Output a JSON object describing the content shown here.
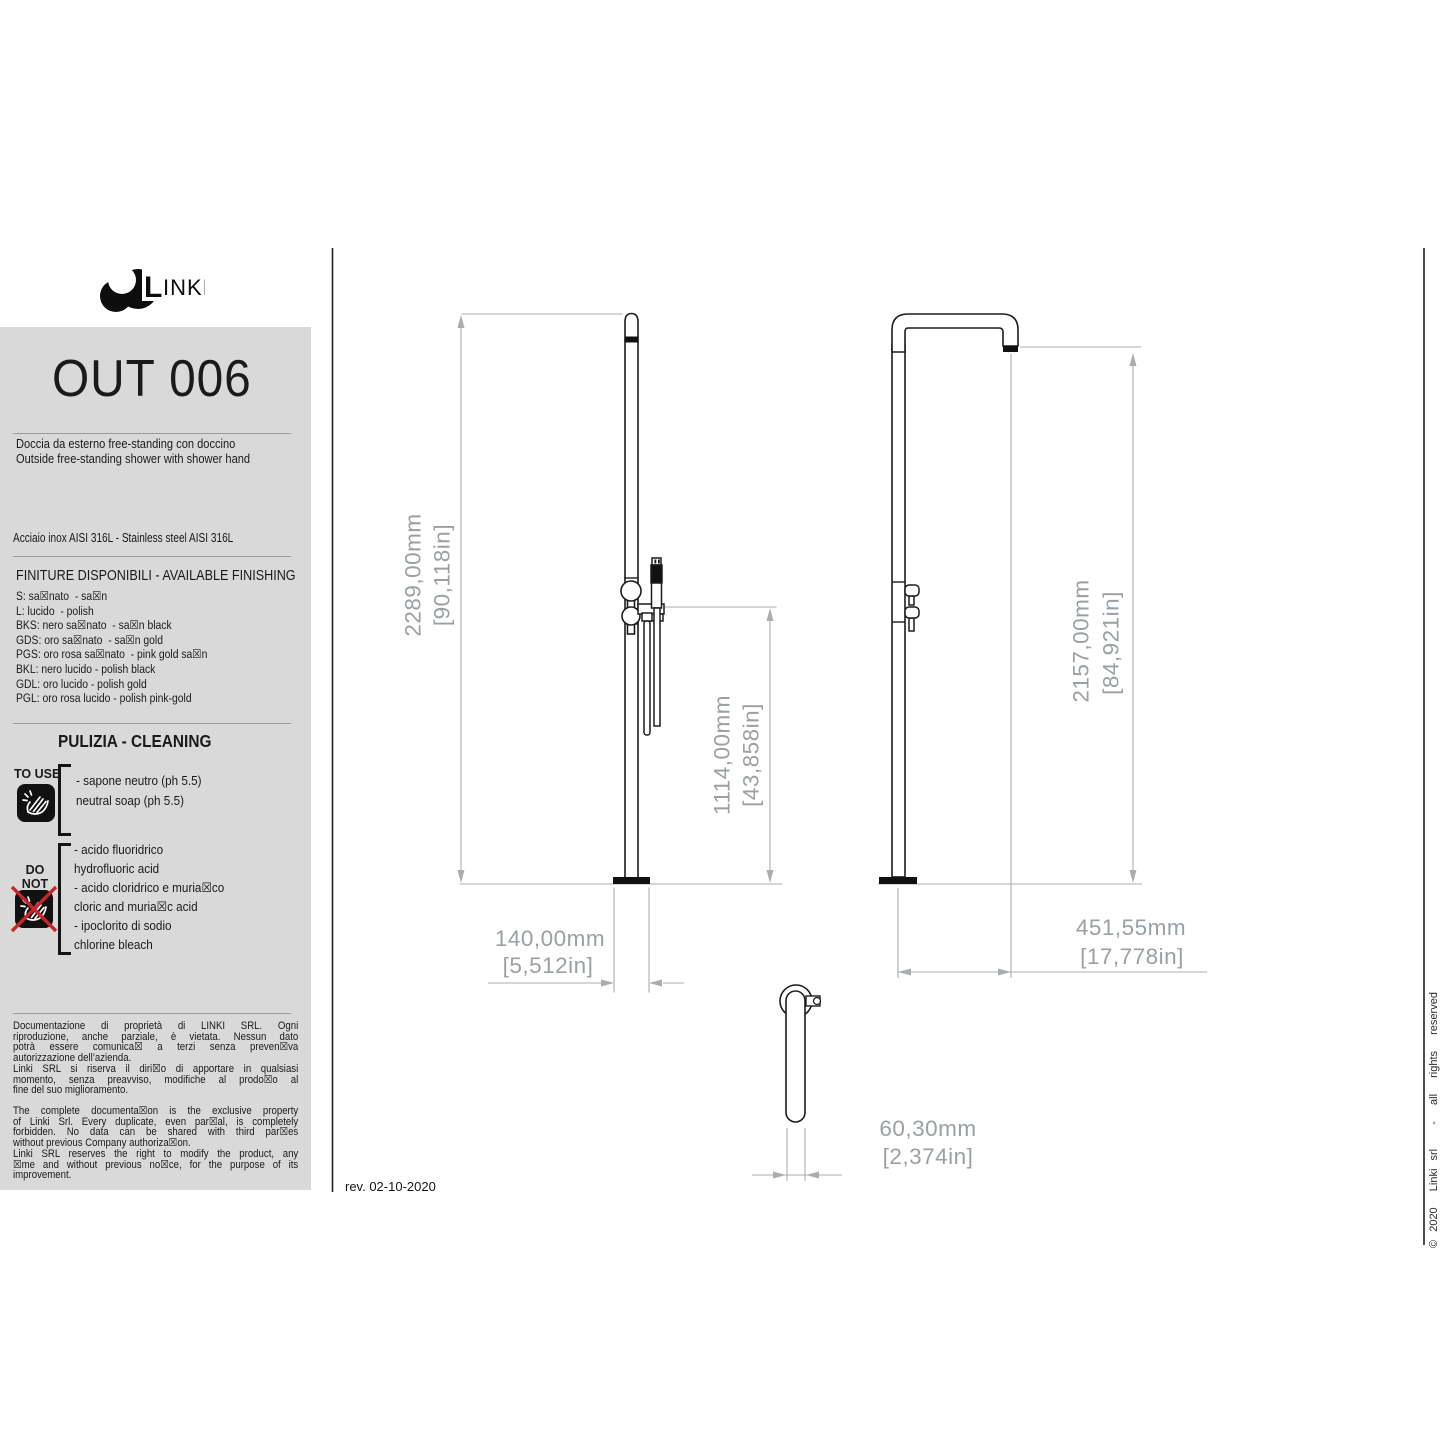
{
  "brand": {
    "name": "LINKI",
    "logo_l": "L",
    "logo_rest": "INKI"
  },
  "header": {
    "code": "OUT 006",
    "description_it": "Doccia da esterno free-standing con doccino",
    "description_en": "Outside free-standing shower with shower hand"
  },
  "specs": {
    "material": "Acciaio inox AISI 316L - Stainless steel AISI 316L",
    "finishing_title": "FINITURE DISPONIBILI - AVAILABLE FINISHING",
    "finishing_options": [
      "S: sa☒nato  - sa☒n",
      "L: lucido  - polish",
      "BKS: nero sa☒nato  - sa☒n black",
      "GDS: oro sa☒nato  - sa☒n gold",
      "PGS: oro rosa sa☒nato  - pink gold sa☒n",
      "BKL: nero lucido - polish black",
      "GDL: oro lucido - polish gold",
      "PGL: oro rosa lucido - polish pink-gold"
    ]
  },
  "cleaning": {
    "title": "PULIZIA - CLEANING",
    "to_use_label": "TO USE",
    "to_use_items": [
      "- sapone neutro (ph 5.5)",
      "neutral soap (ph 5.5)"
    ],
    "do_not_use_label_1": "DO NOT",
    "do_not_use_label_2": "USE",
    "do_not_use_items": [
      "- acido fluoridrico",
      "hydrofluoric acid",
      "- acido cloridrico e muria☒co",
      "cloric and muria☒c acid",
      "- ipoclorito di sodio",
      "chlorine bleach"
    ]
  },
  "legal": {
    "it_lines": [
      "Documentazione di proprietà di LINKI SRL. Ogni",
      "riproduzione, anche parziale, è vietata. Nessun dato",
      "potrà essere comunica☒ a terzi senza preven☒va",
      "autorizzazione dell’azienda.",
      "Linki SRL si riserva il diri☒o di apportare in qualsiasi",
      "momento, senza preavviso, modifiche al prodo☒o al",
      "fine del suo miglioramento."
    ],
    "en_lines": [
      "The complete documenta☒on is the exclusive property",
      "of Linki Srl. Every duplicate, even par☒al, is completely",
      "forbidden. No data can be shared with third par☒es",
      "without previous Company authoriza☒on.",
      "Linki SRL  reserves the right to modify the product, any",
      "☒me and without previous no☒ce, for the purpose of its",
      "improvement."
    ]
  },
  "footer": {
    "revision": "rev. 02-10-2020",
    "copyright": "© 2020  Linki srl   -  all  rights  reserved"
  },
  "dimensions": {
    "front_height": {
      "mm": "2289,00mm",
      "inches": "[90,118in]"
    },
    "mixer_height": {
      "mm": "1114,00mm",
      "inches": "[43,858in]"
    },
    "side_height": {
      "mm": "2157,00mm",
      "inches": "[84,921in]"
    },
    "base_width": {
      "mm": "140,00mm",
      "inches": "[5,512in]"
    },
    "depth": {
      "mm": "451,55mm",
      "inches": "[17,778in]"
    },
    "arm_width": {
      "mm": "60,30mm",
      "inches": "[2,374in]"
    }
  },
  "colors": {
    "panel_bg": "#d9d9d9",
    "dim_gray": "#9aa0a3",
    "line_black": "#1c1c1c",
    "warning_red": "#c8242b"
  }
}
